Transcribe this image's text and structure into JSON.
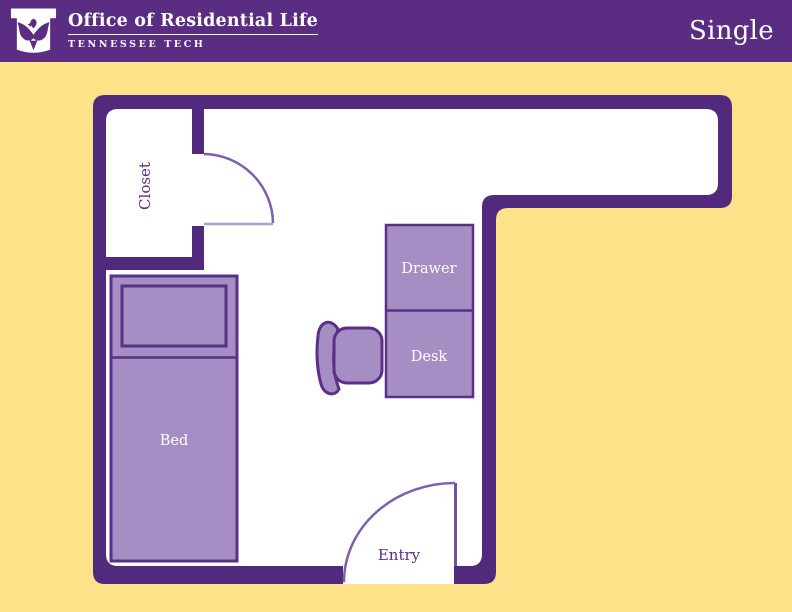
{
  "header": {
    "org_name": "Office of Residential Life",
    "org_subtitle": "TENNESSEE TECH",
    "page_title": "Single"
  },
  "floorplan": {
    "closet_label": "Closet",
    "entry_label": "Entry",
    "bed_label": "Bed",
    "drawer_label": "Drawer",
    "desk_label": "Desk"
  },
  "icons": {
    "logo": "tennessee-tech-eagle-logo"
  },
  "colors": {
    "header-bg": "#5a2d82",
    "header-text": "#ffffff",
    "canvas-bg": "#fde289",
    "wall": "#522a7d",
    "floor": "#ffffff",
    "furniture-fill": "#a48ec3",
    "furniture-stroke": "#5b2f86",
    "door-arc": "#7e5fab",
    "door-leaf-light": "#b19cd6",
    "door-leaf-dark": "#74519e",
    "room-label": "#5b2d87",
    "furniture-label": "#ffffff"
  }
}
